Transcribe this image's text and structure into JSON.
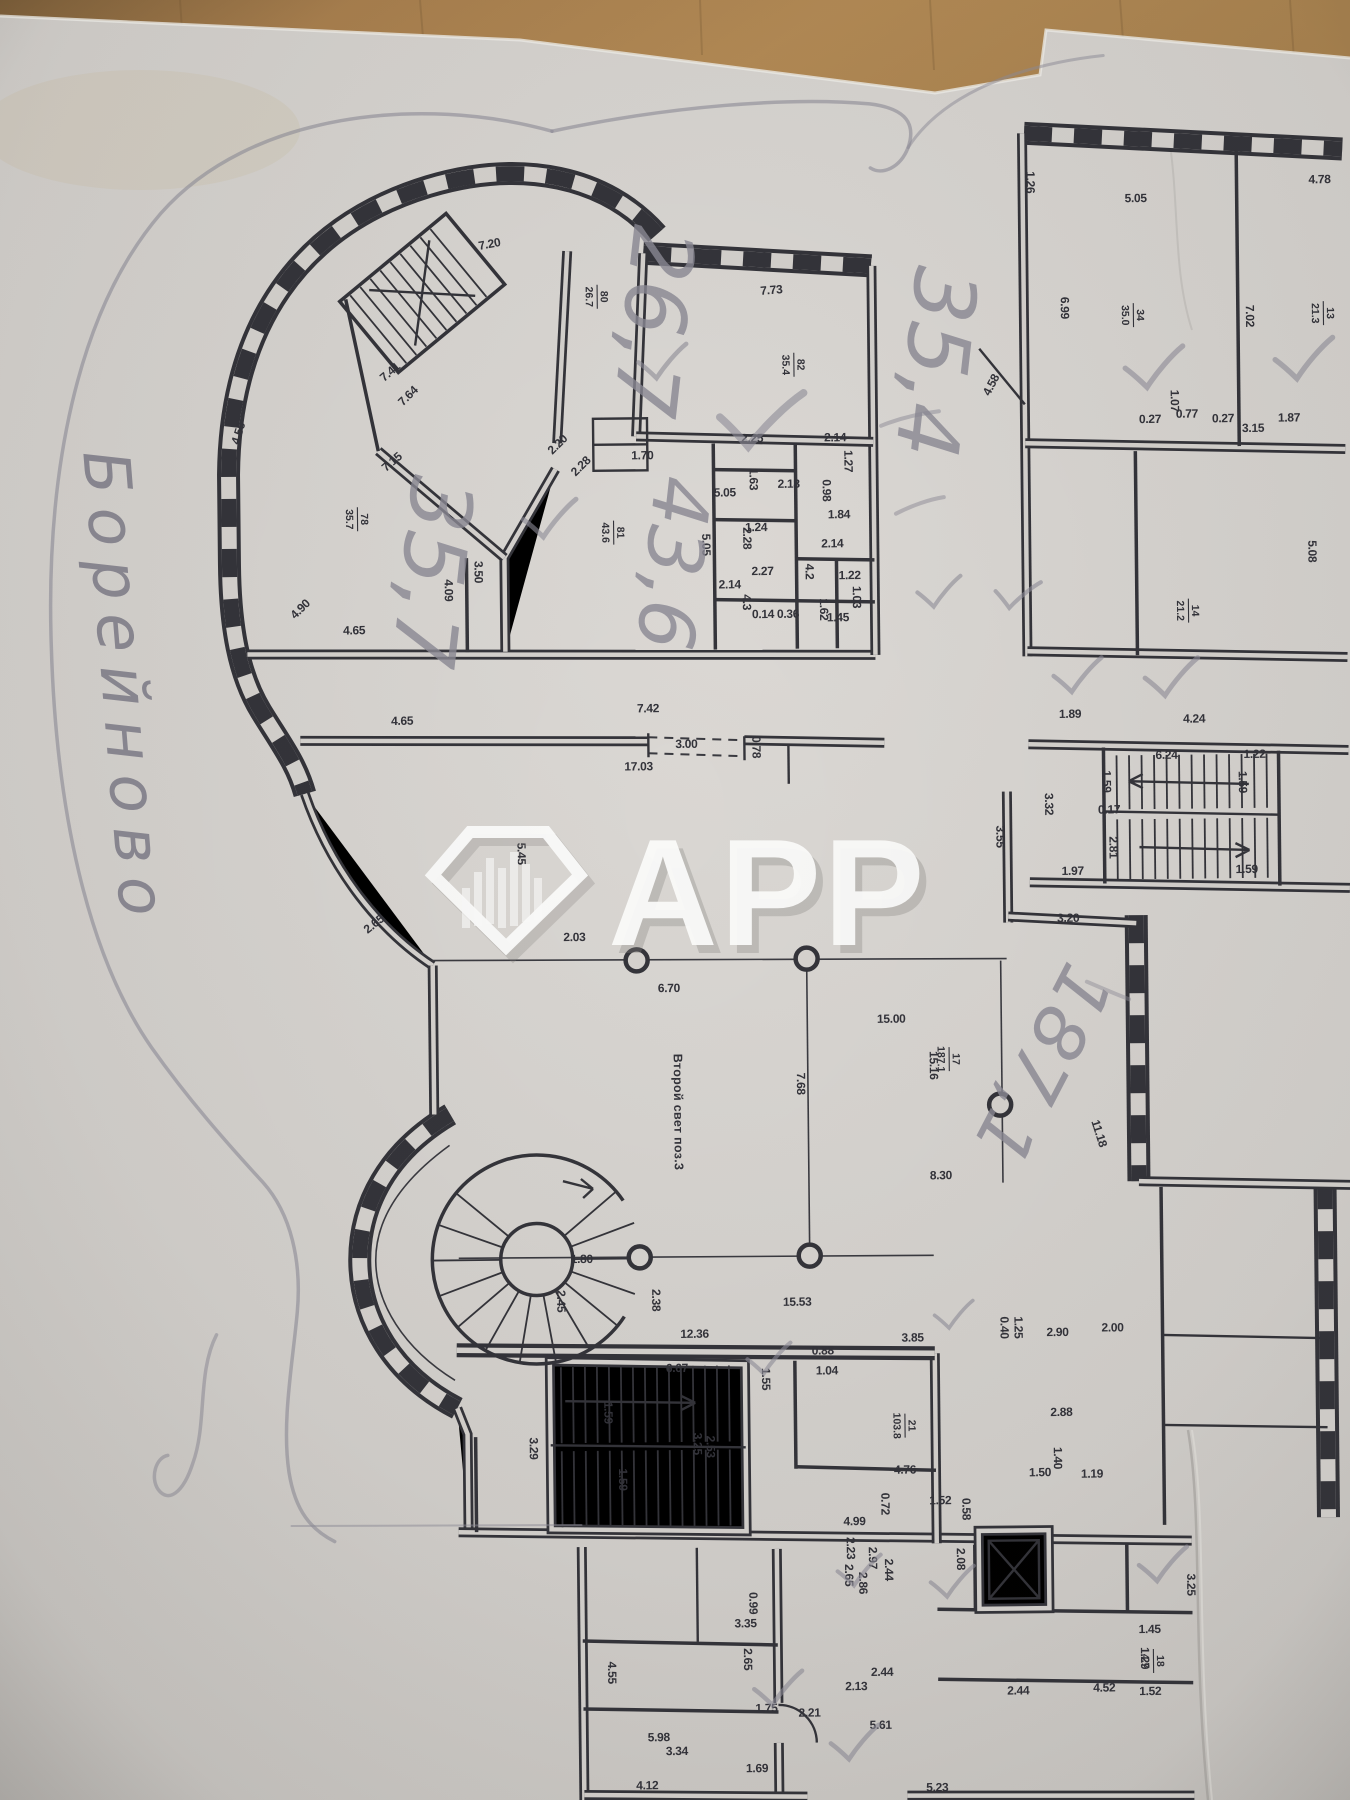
{
  "watermark": {
    "brand": "APP",
    "icon": "diamond-buildings"
  },
  "pencil": {
    "street_note": "Борейново",
    "area_notes": [
      {
        "t": "26,7",
        "x": 630,
        "y": 318,
        "r": 97,
        "s": 86
      },
      {
        "t": "35,4",
        "x": 912,
        "y": 362,
        "r": 97,
        "s": 86
      },
      {
        "t": "35,7",
        "x": 406,
        "y": 566,
        "r": 97,
        "s": 86
      },
      {
        "t": "43,6",
        "x": 650,
        "y": 560,
        "r": 97,
        "s": 78
      },
      {
        "t": "187,1",
        "x": 1018,
        "y": 1056,
        "r": 118,
        "s": 74
      }
    ],
    "checkmarks": [
      [
        660,
        362,
        1,
        0
      ],
      [
        752,
        420,
        1.7,
        5
      ],
      [
        545,
        518,
        1.1,
        0
      ],
      [
        1150,
        373,
        1.2,
        0
      ],
      [
        1300,
        366,
        1.2,
        0
      ],
      [
        935,
        595,
        0.9,
        0
      ],
      [
        1013,
        597,
        0.9,
        10
      ],
      [
        1072,
        680,
        1,
        0
      ],
      [
        1165,
        683,
        1.1,
        0
      ],
      [
        757,
        1360,
        0.9,
        0
      ],
      [
        943,
        1318,
        0.8,
        0
      ],
      [
        845,
        1573,
        0.9,
        0
      ],
      [
        938,
        1585,
        0.9,
        0
      ],
      [
        762,
        1690,
        1,
        0
      ],
      [
        838,
        1745,
        1,
        0
      ],
      [
        1148,
        1570,
        1,
        0
      ]
    ]
  },
  "plan": {
    "atrium_label": "Второй свет поз.3",
    "stair_label": "7.41",
    "room_labels": [
      {
        "top": "80",
        "bottom": "26.7",
        "x": 604,
        "y": 296,
        "r": 90
      },
      {
        "top": "78",
        "bottom": "35.7",
        "x": 362,
        "y": 516,
        "r": 90
      },
      {
        "top": "81",
        "bottom": "43.6",
        "x": 618,
        "y": 532,
        "r": 90
      },
      {
        "top": "82",
        "bottom": "35.4",
        "x": 800,
        "y": 366,
        "r": 90
      },
      {
        "top": "34",
        "bottom": "35.0",
        "x": 1140,
        "y": 320,
        "r": 90
      },
      {
        "top": "13",
        "bottom": "21.3",
        "x": 1330,
        "y": 320,
        "r": 90
      },
      {
        "top": "14",
        "bottom": "21.2",
        "x": 1192,
        "y": 616,
        "r": 90
      },
      {
        "top": "17",
        "bottom": "187.1",
        "x": 948,
        "y": 1062,
        "r": 90
      },
      {
        "top": "21",
        "bottom": "103.8",
        "x": 900,
        "y": 1428,
        "r": 90
      },
      {
        "top": "18",
        "bottom": "4.7",
        "x": 1146,
        "y": 1666,
        "r": 90
      }
    ],
    "columns": [
      [
        636,
        960
      ],
      [
        806,
        960
      ],
      [
        998,
        1108
      ],
      [
        636,
        1257
      ],
      [
        806,
        1257
      ]
    ],
    "dimensions": [
      [
        "7.20",
        497,
        246,
        -10
      ],
      [
        "7.64",
        416,
        396,
        -44
      ],
      [
        "7.41",
        398,
        372,
        -40
      ],
      [
        "7.15",
        399,
        462,
        -40
      ],
      [
        "4.56",
        247,
        430,
        -72
      ],
      [
        "4.90",
        306,
        608,
        -44
      ],
      [
        "4.09",
        448,
        588,
        90
      ],
      [
        "3.50",
        478,
        570,
        90
      ],
      [
        "4.65",
        357,
        631,
        0
      ],
      [
        "2.20",
        565,
        446,
        -44
      ],
      [
        "2.28",
        588,
        468,
        -44
      ],
      [
        "1.70",
        647,
        459,
        0
      ],
      [
        "5.05",
        729,
        497,
        0
      ],
      [
        "5.05",
        706,
        545,
        90
      ],
      [
        "2.25",
        757,
        443,
        0
      ],
      [
        "2.14",
        840,
        443,
        0
      ],
      [
        "1.63",
        754,
        480,
        90
      ],
      [
        "2.18",
        793,
        489,
        0
      ],
      [
        "1.27",
        849,
        463,
        90
      ],
      [
        "0.98",
        827,
        492,
        90
      ],
      [
        "1.84",
        843,
        520,
        0
      ],
      [
        "1.24",
        760,
        532,
        0
      ],
      [
        "2.28",
        747,
        539,
        90
      ],
      [
        "2.14",
        836,
        549,
        0
      ],
      [
        "2.27",
        766,
        576,
        0
      ],
      [
        "4.2",
        809,
        573,
        90
      ],
      [
        "4.3",
        746,
        603,
        90
      ],
      [
        "2.14",
        733,
        589,
        0
      ],
      [
        "1.22",
        853,
        581,
        0
      ],
      [
        "1.03",
        856,
        599,
        90
      ],
      [
        "1.62",
        823,
        611,
        90
      ],
      [
        "0.36",
        791,
        619,
        0
      ],
      [
        "0.14",
        766,
        619,
        0
      ],
      [
        "1.45",
        841,
        623,
        0
      ],
      [
        "7.42",
        650,
        712,
        0
      ],
      [
        "3.00",
        688,
        748,
        0
      ],
      [
        "17.03",
        640,
        770,
        0
      ],
      [
        "0.78",
        754,
        748,
        90
      ],
      [
        "4.65",
        404,
        722,
        0
      ],
      [
        "2.65",
        376,
        924,
        -38
      ],
      [
        "2.03",
        574,
        940,
        0
      ],
      [
        "5.45",
        518,
        852,
        90
      ],
      [
        "7.73",
        778,
        295,
        -4
      ],
      [
        "1.26",
        1034,
        186,
        90
      ],
      [
        "5.05",
        1143,
        207,
        0
      ],
      [
        "6.99",
        1067,
        312,
        90
      ],
      [
        "4.78",
        1327,
        190,
        0
      ],
      [
        "7.02",
        1252,
        322,
        90
      ],
      [
        "4.58",
        1000,
        390,
        -62
      ],
      [
        "0.27",
        1155,
        428,
        0
      ],
      [
        "0.77",
        1192,
        423,
        0
      ],
      [
        "0.27",
        1228,
        428,
        0
      ],
      [
        "1.07",
        1176,
        406,
        90
      ],
      [
        "3.15",
        1258,
        438,
        0
      ],
      [
        "1.87",
        1294,
        428,
        0
      ],
      [
        "5.08",
        1312,
        558,
        90
      ],
      [
        "4.24",
        1196,
        728,
        0
      ],
      [
        "1.89",
        1072,
        722,
        0
      ],
      [
        "6.24",
        1168,
        764,
        0
      ],
      [
        "1.22",
        1256,
        764,
        0
      ],
      [
        "1.59",
        1104,
        786,
        90
      ],
      [
        "1.59",
        1240,
        788,
        90
      ],
      [
        "0.17",
        1110,
        818,
        0
      ],
      [
        "2.81",
        1110,
        852,
        90
      ],
      [
        "1.97",
        1073,
        879,
        0
      ],
      [
        "1.59",
        1247,
        879,
        0
      ],
      [
        "3.32",
        1046,
        808,
        90
      ],
      [
        "3.20",
        1068,
        926,
        0
      ],
      [
        "3.55",
        997,
        840,
        90
      ],
      [
        "6.70",
        668,
        992,
        0
      ],
      [
        "7.68",
        795,
        1085,
        90
      ],
      [
        "15.00",
        890,
        1025,
        0
      ],
      [
        "15.16",
        928,
        1068,
        90
      ],
      [
        "8.30",
        938,
        1182,
        0
      ],
      [
        "11.18",
        1093,
        1139,
        73
      ],
      [
        "1.80",
        578,
        1262,
        0
      ],
      [
        "2.45",
        553,
        1300,
        90
      ],
      [
        "2.38",
        648,
        1300,
        90
      ],
      [
        "15.53",
        793,
        1307,
        0
      ],
      [
        "12.36",
        690,
        1338,
        0
      ],
      [
        "3.85",
        908,
        1344,
        0
      ],
      [
        "2.90",
        1053,
        1340,
        0
      ],
      [
        "0.40",
        996,
        1331,
        90
      ],
      [
        "1.25",
        1010,
        1331,
        90
      ],
      [
        "2.00",
        1108,
        1336,
        0
      ],
      [
        "0.88",
        818,
        1356,
        0
      ],
      [
        "1.04",
        822,
        1376,
        0
      ],
      [
        "6.67",
        672,
        1372,
        0
      ],
      [
        "1.59",
        599,
        1412,
        90
      ],
      [
        "1.59",
        613,
        1479,
        90
      ],
      [
        "3.29",
        524,
        1447,
        90
      ],
      [
        "1.55",
        757,
        1380,
        90
      ],
      [
        "3.25",
        688,
        1444,
        90
      ],
      [
        "2.53",
        701,
        1447,
        90
      ],
      [
        "4.76",
        899,
        1476,
        0
      ],
      [
        "1.52",
        934,
        1507,
        0
      ],
      [
        "0.58",
        956,
        1512,
        90
      ],
      [
        "0.72",
        875,
        1506,
        90
      ],
      [
        "4.99",
        848,
        1527,
        0
      ],
      [
        "2.88",
        1056,
        1420,
        0
      ],
      [
        "1.50",
        1034,
        1480,
        0
      ],
      [
        "1.19",
        1086,
        1482,
        0
      ],
      [
        "1.40",
        1048,
        1462,
        90
      ],
      [
        "2.08",
        950,
        1562,
        90
      ],
      [
        "2.23",
        840,
        1550,
        90
      ],
      [
        "2.97",
        862,
        1560,
        90
      ],
      [
        "2.65",
        838,
        1577,
        90
      ],
      [
        "2.86",
        852,
        1585,
        90
      ],
      [
        "2.44",
        878,
        1572,
        90
      ],
      [
        "3.35",
        738,
        1628,
        0
      ],
      [
        "0.99",
        742,
        1604,
        90
      ],
      [
        "2.65",
        736,
        1660,
        90
      ],
      [
        "4.55",
        600,
        1672,
        90
      ],
      [
        "5.98",
        650,
        1741,
        0
      ],
      [
        "3.34",
        668,
        1755,
        0
      ],
      [
        "4.12",
        638,
        1789,
        0
      ],
      [
        "1.69",
        748,
        1773,
        0
      ],
      [
        "1.75",
        758,
        1713,
        0
      ],
      [
        "2.21",
        801,
        1718,
        0
      ],
      [
        "2.13",
        848,
        1692,
        0
      ],
      [
        "2.44",
        874,
        1678,
        0
      ],
      [
        "5.61",
        872,
        1731,
        0
      ],
      [
        "5.23",
        928,
        1794,
        0
      ],
      [
        "2.44",
        1010,
        1698,
        0
      ],
      [
        "4.52",
        1096,
        1696,
        0
      ],
      [
        "1.52",
        1142,
        1700,
        0
      ],
      [
        "1.45",
        1142,
        1638,
        0
      ],
      [
        "1.29",
        1133,
        1663,
        90
      ],
      [
        "3.25",
        1180,
        1590,
        90
      ]
    ]
  },
  "colors": {
    "paper": "#d5d2ce",
    "wood": "#a98353",
    "ink": "#33333a",
    "pencil": "#8e8c97"
  }
}
